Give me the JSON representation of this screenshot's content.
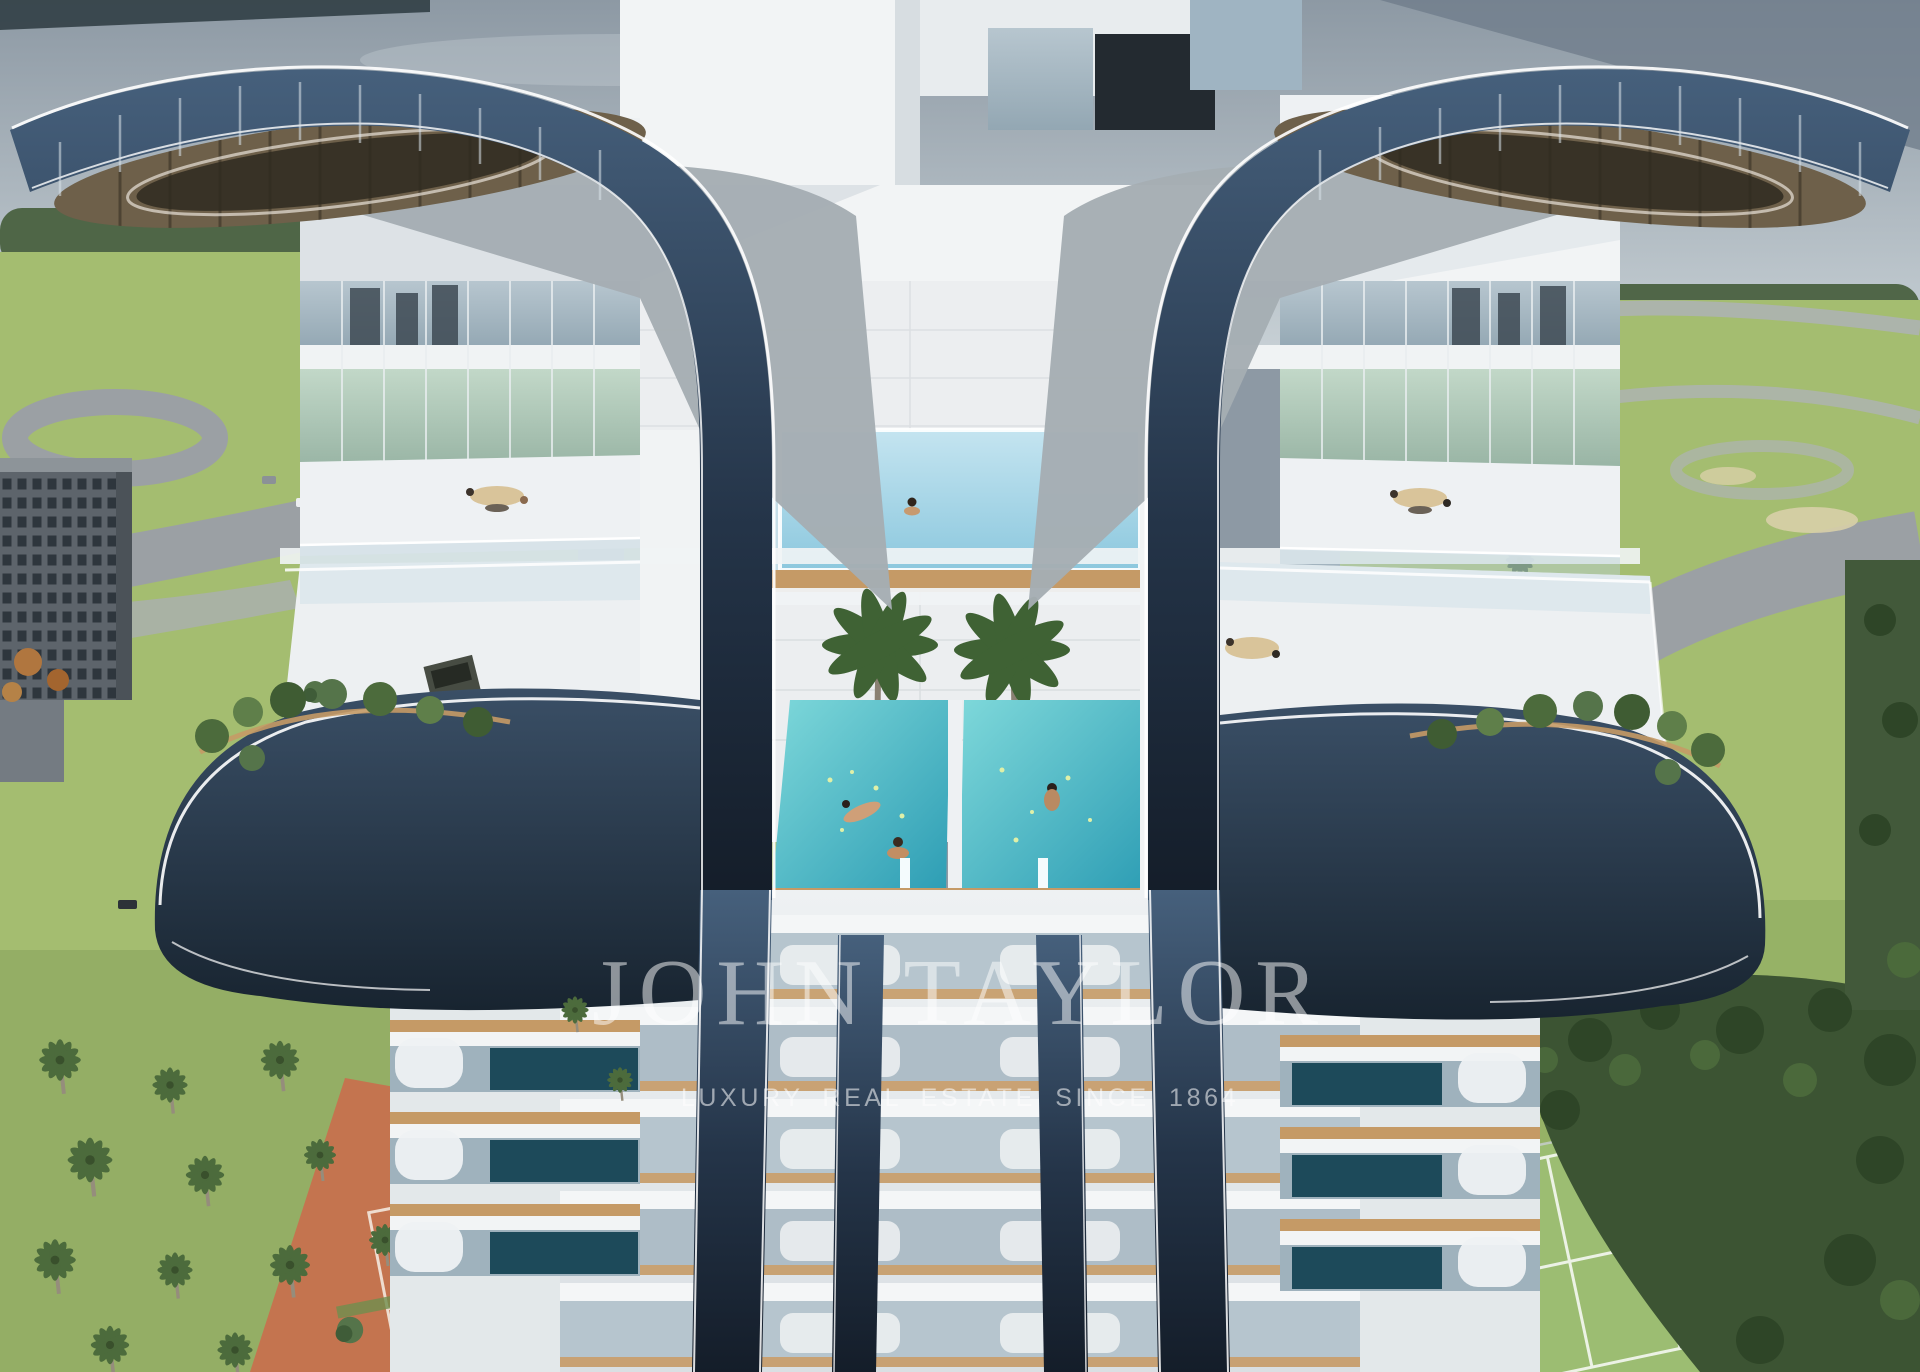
{
  "image_subject": "Aerial architectural rendering of a luxury twin-wing high-rise tower with cascading sky pools, palm court, roof terraces, balcony plunge pools, clay and grass tennis courts, roads and landscaped grounds",
  "watermark": {
    "brand": "JOHN TAYLOR",
    "tagline": "LUXURY REAL ESTATE SINCE 1864"
  },
  "colors": {
    "sky_top": "#8d99a4",
    "sky_bottom": "#c6cfd4",
    "wing_dark": "#16212e",
    "wing_light": "#46607c",
    "building_white": "#f2f4f5",
    "building_shadow": "#d5dbdf",
    "marble": "#eceef0",
    "glass_blue": "#aec3cf",
    "glass_dark": "#24323e",
    "pool_upper": "#a9d8ea",
    "pool_main": "#45b4c4",
    "wood": "#c59a66",
    "grass": "#a4bd70",
    "grass_dark": "#86a35c",
    "forest": "#3c5433",
    "palm": "#4c6b3c",
    "clay_court": "#c4744f",
    "tennis_court": "#9cbd72",
    "road": "#9ba0a4",
    "watermark": "#ffffff"
  }
}
